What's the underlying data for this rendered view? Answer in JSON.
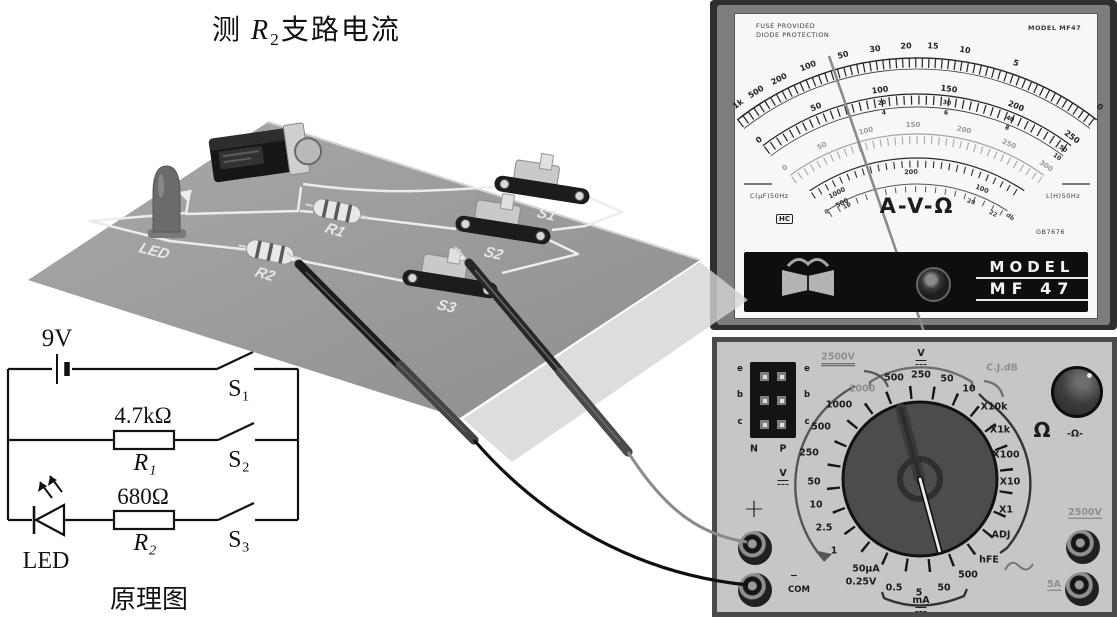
{
  "title": {
    "measure": "测",
    "symbol": "R",
    "symbol_sub": "2",
    "rest": "支路电流"
  },
  "board": {
    "labels": {
      "led": "LED",
      "r1": "R1",
      "r2": "R2",
      "s1": "S1",
      "s2": "S2",
      "s3": "S3"
    }
  },
  "schematic": {
    "caption": "原理图",
    "battery": "9V",
    "r1_value": "4.7kΩ",
    "r1_name": "R₁",
    "r2_value": "680Ω",
    "r2_name": "R₂",
    "led": "LED",
    "s1": "S₁",
    "s2": "S₂",
    "s3": "S₃"
  },
  "meter_face": {
    "fuse_line1": "FUSE PROVIDED",
    "fuse_line2": "DIODE PROTECTION",
    "model_top": "MODEL MF47",
    "ohm_scale": [
      "1k",
      "500",
      "200",
      "100",
      "50",
      "30",
      "20",
      "15",
      "10",
      "5",
      "0"
    ],
    "dc_scale": [
      "0",
      "50",
      "100",
      "150",
      "200",
      "250"
    ],
    "dc_sub": [
      [
        "20",
        "4"
      ],
      [
        "30",
        "6"
      ],
      [
        "40",
        "8"
      ],
      [
        "50",
        "10"
      ]
    ],
    "ac_scale": [
      "0",
      "50",
      "100",
      "150",
      "200",
      "250",
      "300"
    ],
    "inner_scale": [
      "1000",
      "500",
      "200",
      "100"
    ],
    "db_scale": [
      "10",
      "0",
      "20",
      "22"
    ],
    "db_label": "db",
    "center_label": "A-V-Ω",
    "cap_label": "C(μF)50Hz",
    "ind_label": "L(H)50Hz",
    "cert_label": "HC",
    "standard_label": "GB7676",
    "brand_line1": "MODEL",
    "brand_line2": "MF 47"
  },
  "meter_panel": {
    "socket": {
      "left": [
        "e",
        "b",
        "c"
      ],
      "right": [
        "e",
        "b",
        "c"
      ],
      "n": "N",
      "p": "P"
    },
    "hv_label": "2500V",
    "v_top": "V",
    "cj_db": "C.J.dB",
    "acv": [
      "1000",
      "500",
      "250",
      "50",
      "10"
    ],
    "dcv": [
      "1000",
      "500",
      "250",
      "50",
      "10",
      "2.5",
      "1"
    ],
    "v_left": "V",
    "ua_label": "50μA",
    "v025_label": "0.25V",
    "ma": [
      "0.5",
      "5",
      "50",
      "500"
    ],
    "ma_label": "mA",
    "ohm_ranges": [
      "X10k",
      "X1k",
      "X100",
      "X10",
      "X1"
    ],
    "ohm_symbol": "Ω",
    "adj": "ADJ",
    "hfe": "hFE",
    "ohm_adjust": "-Ω-",
    "jack_hv": "2500V",
    "jack_5a": "5A",
    "plus": "+",
    "minus": "−",
    "com": "COM"
  },
  "colors": {
    "board": "#9a9a9a",
    "panel": "#c6c6c6",
    "face": "#f7f7f7",
    "band": "#111111",
    "frame": "#2e2e2e"
  }
}
